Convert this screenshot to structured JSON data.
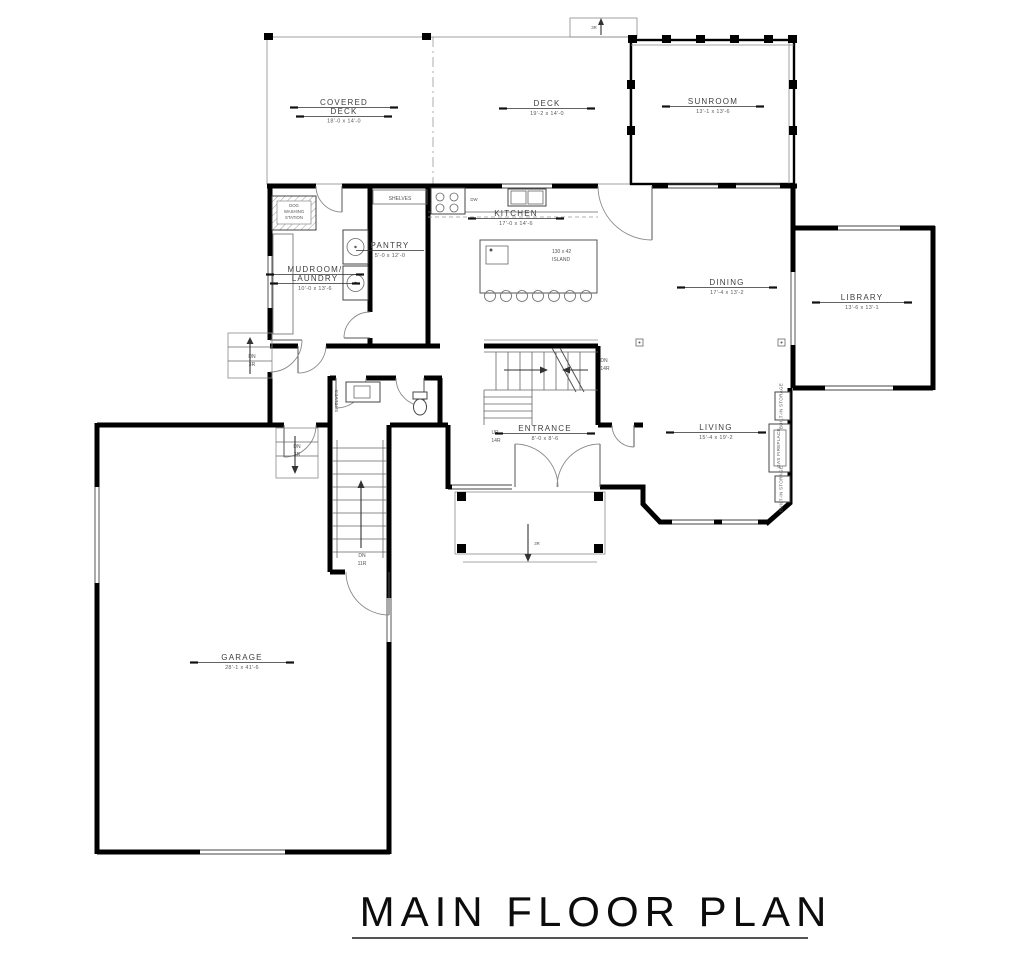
{
  "title": "MAIN FLOOR PLAN",
  "rooms": {
    "covered_deck": {
      "line1": "COVERED",
      "line2": "DECK",
      "dims": "18'-0 x 14'-0"
    },
    "deck": {
      "line1": "DECK",
      "dims": "19'-2 x 14'-0"
    },
    "sunroom": {
      "line1": "SUNROOM",
      "dims": "13'-1 x 13'-6"
    },
    "kitchen": {
      "line1": "KITCHEN",
      "dims": "17'-0 x 14'-6"
    },
    "pantry": {
      "line1": "PANTRY",
      "dims": "5'-0 x 12'-0"
    },
    "mudroom": {
      "line1": "MUDROOM/",
      "line2": "LAUNDRY",
      "dims": "10'-0 x 13'-6"
    },
    "dining": {
      "line1": "DINING",
      "dims": "17'-4 x 13'-2"
    },
    "library": {
      "line1": "LIBRARY",
      "dims": "13'-6 x 13'-1"
    },
    "entrance": {
      "line1": "ENTRANCE",
      "dims": "8'-0 x 8'-6"
    },
    "living": {
      "line1": "LIVING",
      "dims": "15'-4 x 19'-2"
    },
    "garage": {
      "line1": "GARAGE",
      "dims": "28'-1 x 41'-6"
    }
  },
  "features": {
    "dog_wash_1": "DOG",
    "dog_wash_2": "WASHING",
    "dog_wash_3": "STATION",
    "shelves": "SHELVES",
    "island_line1": "130 x 42",
    "island_line2": "ISLAND",
    "dw": "DW",
    "gas_fireplace": "GAS FIREPLACE",
    "builtin_storage": "BUILT-IN STORAGE"
  },
  "stairs": {
    "dn": "DN",
    "up": "UP",
    "r14": "14R",
    "r3": "3R",
    "r11": "11R"
  },
  "colors": {
    "wall": "#000000",
    "line": "#777777",
    "text": "#404040",
    "background": "#ffffff"
  }
}
